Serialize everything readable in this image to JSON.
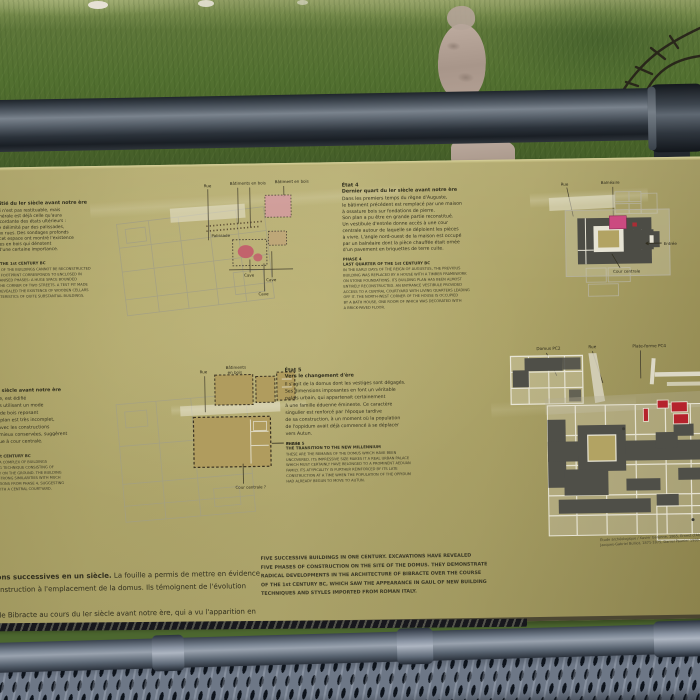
{
  "colors": {
    "panel_khaki": "#b3aa6d",
    "panel_text": "#32301f",
    "plan_dark_walls": "#4f4f48",
    "plan_ghost_lines": "#a09e8a",
    "plan_tan_fill": "#b09c5e",
    "accent_pink": "#cb4a80",
    "accent_rose": "#c2626c",
    "accent_red": "#b5232c",
    "rail_metal": "#5c656f",
    "mesh_metal": "#6d7786",
    "grass_green": "#527030",
    "path_tan": "#b3a094"
  },
  "panel": {
    "etats12": {
      "title": "États 1 & 2",
      "subtitle": "Première moitié du Ier siècle avant notre ère",
      "fr_lines": [
        "Le détail du bâti n'est pas restituable, mais",
        "son emprise générale est déjà celle qu'aura",
        "la demeure concordante des états ultérieurs :",
        "un vaste espace délimité par des palissades,",
        "à l'angle de deux rues. Des sondages profonds",
        "à l'intérieur de cet espace ont montré l'existence",
        "de grandes caves en bois qui dénotent",
        "des bâtiments d'une certaine importance."
      ],
      "phase_title": "PHASES 1 & 2",
      "phase_subtitle": "FIRST HALF OF THE 1st CENTURY BC",
      "en_lines": [
        "THE EXACT DETAIL OF THE BUILDINGS CANNOT BE RECONSTRUCTED",
        "BUT THE GENERAL FOOTPRINT CORRESPONDS TO ENCLOSED IN",
        "THE LATER REORGANISED PHASES: A HUGE SPACE BOUNDED",
        "BY PALISADES AT THE CORNER OF TWO STREETS. A TEST PIT MADE",
        "INSIDE THE AREA REVEALED THE EXISTENCE OF WOODEN CELLARS",
        "WITH THE CHARACTERISTICS OF QUITE SUBSTANTIAL BUILDINGS."
      ]
    },
    "etat3": {
      "title": "État 3",
      "subtitle": "Troisième quart du Ier siècle avant notre ère",
      "fr_lines": [
        "Après la conquête romaine, est édifié",
        "un ensemble de bâtiments utilisant un mode",
        "de construction à châssis de bois reposant",
        "directement sur le sol. Le plan est très incomplet,",
        "mais ses relations fortes avec les constructions",
        "de l'état 4, partiellement mieux conservées, suggèrent",
        "une demeure aristocratique à cour centrale."
      ],
      "phase_title": "PHASE 3",
      "phase_subtitle": "THIRD QUARTER OF THE 1st CENTURY BC",
      "en_lines": [
        "AFTER THE ROMAN CONQUEST, A COMPLEX OF BUILDINGS",
        "WAS ERECTED USING A BUILDING TECHNIQUE CONSISTING OF",
        "A WOODEN FRAME SET DIRECTLY ON THE GROUND. THE BUILDING",
        "PLAN IS INCOMPLETE BUT HAD STRONG SIMILARITIES WITH MUCH",
        "BETTER PRESERVED CONSTRUCTIONS FROM PHASE 4, SUGGESTING",
        "AN ARISTOCRATIC RESIDENCE WITH A CENTRAL COURTYARD."
      ]
    },
    "etat4": {
      "title": "État 4",
      "subtitle": "Dernier quart du Ier siècle avant notre ère",
      "fr_lines": [
        "Dans les premiers temps du règne d'Auguste,",
        "le bâtiment précédent est remplacé par une maison",
        "à ossature bois sur fondations de pierre.",
        "Son plan a pu être en grande partie reconstitué.",
        "Un vestibule d'entrée donne accès à une cour",
        "centrale autour de laquelle se déploient les pièces",
        "à vivre. L'angle nord-ouest de la maison est occupé",
        "par un balnéaire dont la pièce chauffée était ornée",
        "d'un pavement en briquettes de terre cuite."
      ],
      "phase_title": "PHASE 4",
      "phase_subtitle": "LAST QUARTER OF THE 1st CENTURY BC",
      "en_lines": [
        "IN THE EARLY DAYS OF THE REIGN OF AUGUSTUS, THE PREVIOUS",
        "BUILDING WAS REPLACED BY A HOUSE WITH A TIMBER FRAMEWORK",
        "ON STONE FOUNDATIONS. ITS BUILDING PLAN HAS BEEN ALMOST",
        "ENTIRELY RECONSTRUCTED. AN ENTRANCE VESTIBULE PROVIDED",
        "ACCESS TO A CENTRAL COURTYARD WITH LIVING QUARTERS LEADING",
        "OFF IT. THE NORTH-WEST CORNER OF THE HOUSE IS OCCUPIED",
        "BY A BATH HOUSE, ONE ROOM OF WHICH WAS DECORATED WITH",
        "A BRICK-PAVED FLOOR."
      ]
    },
    "etat5": {
      "title": "État 5",
      "subtitle": "Vers le changement d'ère",
      "fr_lines": [
        "Il s'agit de la domus dont les vestiges sont dégagés.",
        "Ses dimensions imposantes en font un véritable",
        "palais urbain, qui appartenait certainement",
        "à une famille éduenne éminente. Ce caractère",
        "singulier est renforcé par l'époque tardive",
        "de sa construction, à un moment où la population",
        "de l'oppidum avait déjà commencé à se déplacer",
        "vers Autun."
      ],
      "phase_title": "PHASE 5",
      "phase_subtitle": "THE TRANSITION TO THE NEW MILLENNIUM",
      "en_lines": [
        "THESE ARE THE REMAINS OF THE DOMUS WHICH HAVE BEEN",
        "UNCOVERED. ITS IMPRESSIVE SIZE MAKES IT A REAL URBAN PALACE",
        "WHICH MUST CERTAINLY HAVE BELONGED TO A PROMINENT AEDUAN",
        "FAMILY. ITS ATYPICALITY IS FURTHER REINFORCED BY ITS LATE",
        "CONSTRUCTION AT A TIME WHEN THE POPULATION OF THE OPPIDUM",
        "HAD ALREADY BEGUN TO MOVE TO AUTUN."
      ]
    },
    "plan12_labels": {
      "rue": "Rue",
      "batiments_bois": "Bâtiments en bois",
      "batiment_bois": "Bâtiment en bois",
      "palissade": "Palissade",
      "cave": "Cave"
    },
    "plan3_labels": {
      "rue": "Rue",
      "batiments": "Bâtiments",
      "en_bois": "en bois",
      "entree": "Entrée",
      "cour_centrale": "Cour centrale ?"
    },
    "plan4_labels": {
      "rue": "Rue",
      "balneaire": "Balnéaire",
      "entree": "Entrée",
      "cour_centrale": "Cour centrale"
    },
    "plan5_labels": {
      "domus": "Domus PC2",
      "rue": "Rue",
      "plateforme": "Plate-forme PC4"
    },
    "intro": {
      "fr_lead": "Cinq constructions successives en un siècle.",
      "fr_rest": " La fouille a permis de mettre en évidence",
      "fr_lines": [
        "cinq phases de construction à l'emplacement de la domus. Ils témoignent de l'évolution radicale",
        "de l'architecture de Bibracte au cours du Ier siècle avant notre ère, qui a vu l'apparition en",
        "Gaule de techniques et de styles de construction nouveaux, issus de l'Italie romaine."
      ],
      "en_lines": [
        "FIVE SUCCESSIVE BUILDINGS IN ONE CENTURY. EXCAVATIONS HAVE REVEALED",
        "FIVE PHASES OF CONSTRUCTION ON THE SITE OF THE DOMUS. THEY DEMONSTRATE",
        "RADICAL DEVELOPMENTS IN THE ARCHITECTURE OF BIBRACTE OVER THE COURSE",
        "OF THE 1st CENTURY BC, WHICH SAW THE APPEARANCE IN GAUL OF NEW BUILDING",
        "TECHNIQUES AND STYLES IMPORTED FROM ROMAN ITALY."
      ],
      "credits_lines": [
        "Étude archéologique / Xavier Garenne, 1865, Ernest d'Aboville,",
        "Jacques-Gabriel Bulliot, 1871-1875, Daniel Paunier 1988-1997"
      ]
    }
  }
}
